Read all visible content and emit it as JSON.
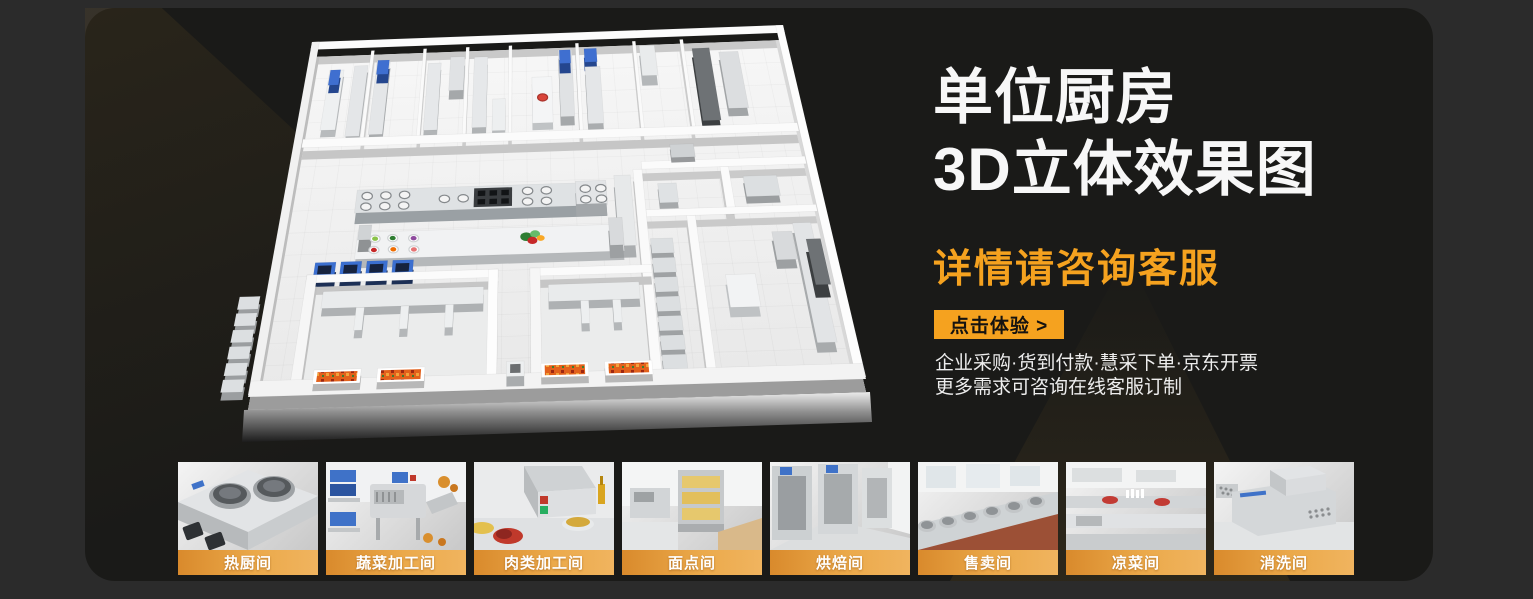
{
  "hero": {
    "title_line1": "单位厨房",
    "title_line2": "3D立体效果图",
    "consult_heading": "详情请咨询客服",
    "cta_label": "点击体验 >",
    "info_line1": "企业采购·货到付款·慧采下单·京东开票",
    "info_line2": "更多需求可咨询在线客服订制"
  },
  "colors": {
    "accent_orange": "#F5A21F",
    "label_band_start": "#D98A2C",
    "label_band_end": "#F0B45F",
    "panel_background": "#1A1A18",
    "page_background": "#2B2B2B"
  },
  "thumbnails": {
    "items": [
      {
        "label": "热厨间"
      },
      {
        "label": "蔬菜加工间"
      },
      {
        "label": "肉类加工间"
      },
      {
        "label": "面点间"
      },
      {
        "label": "烘焙间"
      },
      {
        "label": "售卖间"
      },
      {
        "label": "凉菜间"
      },
      {
        "label": "消洗间"
      }
    ]
  }
}
